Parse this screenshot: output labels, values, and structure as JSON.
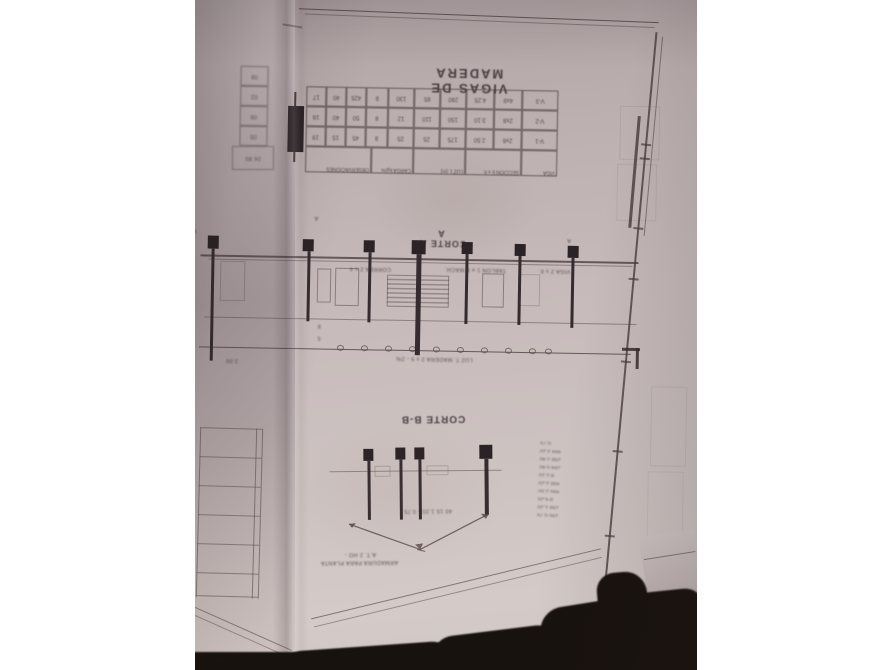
{
  "photo": {
    "title": "VIGAS DE MADERA",
    "section_aa": {
      "label": "CORTE A-A",
      "caption": "LUZ T. MADERA  2 x 6  -  2%",
      "dim_small_1": "8",
      "dim_small_2": "5",
      "left_dim": "2.00",
      "beam_notes": [
        "CORREA 2 x 4",
        "TABLON 1 x 8 MACH.",
        "VIGA 2 x 6"
      ],
      "marks": [
        "A",
        "A",
        "W"
      ]
    },
    "section_bb": {
      "label": "CORTE B-B",
      "caption_1": "A.T. 2 HO -",
      "caption_2": "ARMADURA PARA PLANTA",
      "dims": "40   15   1.20 - 0.75"
    },
    "tables": {
      "main": {
        "headers": [
          "VIGA",
          "SECCION b x h",
          "LUZ L (m)",
          "CARGA kg/m",
          "OBSERVACIONES"
        ],
        "rows": [
          [
            "V-1",
            "2x6",
            "2.50",
            "175",
            "25",
            "25",
            "8",
            "45",
            "15",
            "19"
          ],
          [
            "V-2",
            "2x8",
            "3.10",
            "150",
            "110",
            "12",
            "8",
            "50",
            "40",
            "16"
          ],
          [
            "V-3",
            "4x8",
            "4.25",
            "280",
            "85",
            "130",
            "8",
            "425",
            "40",
            "17"
          ]
        ]
      },
      "side": {
        "cells": [
          "05",
          "09",
          "02",
          "08"
        ],
        "footer": "26  80"
      }
    },
    "notes": [
      "2x6  0.75",
      "2x8  1.20",
      "d 4.25",
      "4x6  2.50",
      "4x8  3.20",
      "d 2.10",
      "2x4  0.40",
      "2x8  2.40",
      "4x4  3.10",
      "0.75"
    ]
  },
  "colors": {
    "paper": "#c6bbba",
    "paper_shadow": "#a89b9e",
    "ink": "#564749",
    "post": "#2a2225",
    "surface_dark": "#18120e",
    "page_margin": "#ffffff"
  }
}
